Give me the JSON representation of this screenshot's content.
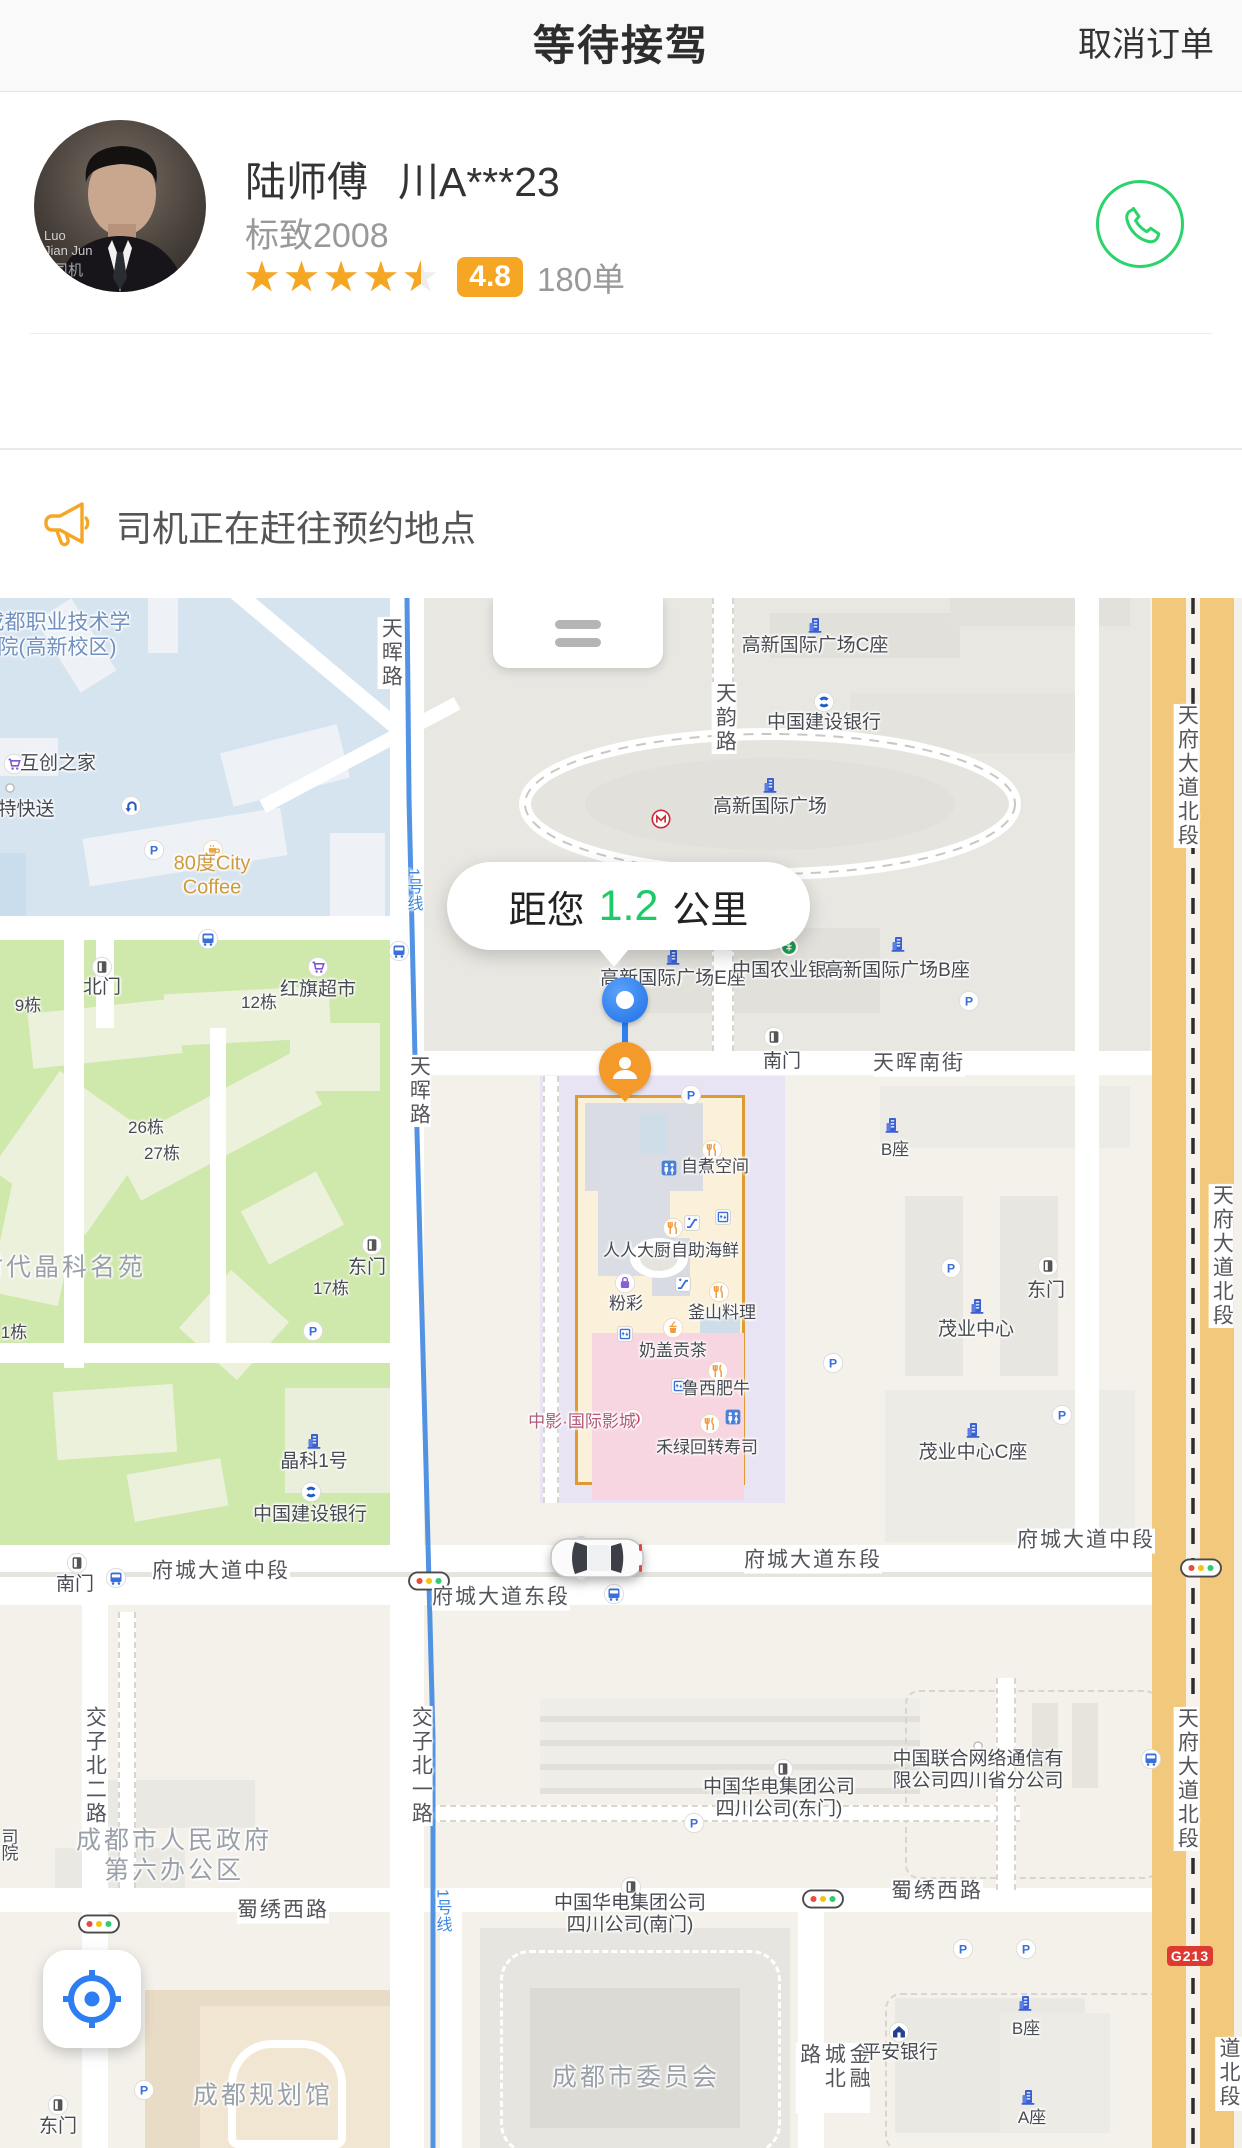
{
  "header": {
    "title": "等待接驾",
    "cancel_button": "取消订单"
  },
  "driver": {
    "name": "陆师傅",
    "plate": "川A***23",
    "car_model": "标致2008",
    "rating_value": 4.5,
    "rating_badge": "4.8",
    "order_count": "180单",
    "avatar_text": [
      "Luo",
      "Jian Jun",
      "安司机"
    ]
  },
  "notice": {
    "text": "司机正在赶往预约地点"
  },
  "colors": {
    "accent_orange": "#F5A623",
    "phone_green": "#2BD36B",
    "distance_green": "#1DCB66",
    "metro_blue": "#3F87E0",
    "avenue_orange": "#F2C87C"
  },
  "map": {
    "distance_bubble": {
      "prefix": "距您",
      "value": "1.2",
      "unit": "公里"
    },
    "g213_badge": "G213",
    "labels": [
      {
        "t": "成都职业技术学\n院(高新校区)",
        "x": 57,
        "y": 38,
        "c": "blue ml"
      },
      {
        "t": "天晖路",
        "x": 390,
        "y": 55,
        "c": "road vert"
      },
      {
        "t": "互创之家",
        "x": 58,
        "y": 166
      },
      {
        "t": "特快送",
        "x": 26,
        "y": 212
      },
      {
        "t": "80度City\nCoffee",
        "x": 212,
        "y": 278,
        "c": "orange ml"
      },
      {
        "t": "高新国际广场C座",
        "x": 815,
        "y": 48
      },
      {
        "t": "中国建设银行",
        "x": 824,
        "y": 125
      },
      {
        "t": "天韵路",
        "x": 724,
        "y": 120,
        "c": "road vert"
      },
      {
        "t": "高新国际广场",
        "x": 770,
        "y": 209
      },
      {
        "t": "天府大道北段",
        "x": 1186,
        "y": 178,
        "c": "road vert"
      },
      {
        "t": "1号线",
        "x": 412,
        "y": 292,
        "c": "metro vert"
      },
      {
        "t": "北门",
        "x": 102,
        "y": 390
      },
      {
        "t": "9栋",
        "x": 28,
        "y": 408,
        "c": "small"
      },
      {
        "t": "12栋",
        "x": 259,
        "y": 405,
        "c": "small"
      },
      {
        "t": "红旗超市",
        "x": 318,
        "y": 392
      },
      {
        "t": "26栋",
        "x": 146,
        "y": 530,
        "c": "small"
      },
      {
        "t": "27栋",
        "x": 162,
        "y": 556,
        "c": "small"
      },
      {
        "t": "时代晶科名苑",
        "x": 62,
        "y": 670,
        "c": "gray"
      },
      {
        "t": "东门",
        "x": 367,
        "y": 670
      },
      {
        "t": "17栋",
        "x": 331,
        "y": 691,
        "c": "small"
      },
      {
        "t": "1栋",
        "x": 14,
        "y": 735,
        "c": "small"
      },
      {
        "t": "晶科1号",
        "x": 314,
        "y": 864
      },
      {
        "t": "中国建设银行",
        "x": 310,
        "y": 917
      },
      {
        "t": "南门",
        "x": 75,
        "y": 987
      },
      {
        "t": "府城大道中段",
        "x": 221,
        "y": 974,
        "c": "road"
      },
      {
        "t": "府城大道东段",
        "x": 501,
        "y": 1000,
        "c": "road"
      },
      {
        "t": "府城大道东段",
        "x": 813,
        "y": 963,
        "c": "road"
      },
      {
        "t": "府城大道中段",
        "x": 1086,
        "y": 943,
        "c": "road"
      },
      {
        "t": "交子北一路",
        "x": 420,
        "y": 1168,
        "c": "road vert"
      },
      {
        "t": "交子北二路",
        "x": 94,
        "y": 1168,
        "c": "road vert"
      },
      {
        "t": "蜀绣西路",
        "x": 283,
        "y": 1313,
        "c": "road"
      },
      {
        "t": "蜀绣西路",
        "x": 937,
        "y": 1294,
        "c": "road"
      },
      {
        "t": "成都市人民政府\n第六办公区",
        "x": 174,
        "y": 1258,
        "c": "gray ml"
      },
      {
        "t": "司",
        "x": 10,
        "y": 1240,
        "c": "small"
      },
      {
        "t": "院",
        "x": 10,
        "y": 1256,
        "c": "small"
      },
      {
        "t": "成都规划馆",
        "x": 263,
        "y": 1498,
        "c": "gray"
      },
      {
        "t": "东门",
        "x": 58,
        "y": 1529
      },
      {
        "t": "中国华电集团公司\n四川公司(东门)",
        "x": 779,
        "y": 1201,
        "c": "ml"
      },
      {
        "t": "中国华电集团公司\n四川公司(南门)",
        "x": 630,
        "y": 1317,
        "c": "ml"
      },
      {
        "t": "成都市委员会",
        "x": 636,
        "y": 1480,
        "c": "gray"
      },
      {
        "t": "金融城北路",
        "x": 833,
        "y": 1480,
        "c": "road vert"
      },
      {
        "t": "平安银行",
        "x": 900,
        "y": 1455
      },
      {
        "t": "中国联合网络通信有\n限公司四川省分公司",
        "x": 978,
        "y": 1173,
        "c": "ml"
      },
      {
        "t": "B座",
        "x": 1026,
        "y": 1431,
        "c": "small"
      },
      {
        "t": "A座",
        "x": 1032,
        "y": 1520,
        "c": "small"
      },
      {
        "t": "天府大道北段",
        "x": 1221,
        "y": 658,
        "c": "road vert"
      },
      {
        "t": "天府大道北段",
        "x": 1186,
        "y": 1181,
        "c": "road vert"
      },
      {
        "t": "天府大道北段",
        "x": 1240,
        "y": 1476,
        "c": "road vert"
      },
      {
        "t": "高新国际广场E座",
        "x": 673,
        "y": 381
      },
      {
        "t": "中国农业银行",
        "x": 789,
        "y": 373
      },
      {
        "t": "高新国际广场B座",
        "x": 897,
        "y": 373
      },
      {
        "t": "南门",
        "x": 782,
        "y": 464
      },
      {
        "t": "天晖南街",
        "x": 919,
        "y": 466,
        "c": "road"
      },
      {
        "t": "B座",
        "x": 895,
        "y": 552,
        "c": "small"
      },
      {
        "t": "天晖路",
        "x": 418,
        "y": 493,
        "c": "road vert"
      },
      {
        "t": "东门",
        "x": 1046,
        "y": 693
      },
      {
        "t": "茂业中心",
        "x": 976,
        "y": 732
      },
      {
        "t": "茂业中心C座",
        "x": 973,
        "y": 855
      },
      {
        "t": "自煮空间",
        "x": 715,
        "y": 569,
        "c": "small"
      },
      {
        "t": "人人大厨自助海鲜",
        "x": 671,
        "y": 653,
        "c": "small"
      },
      {
        "t": "粉彩",
        "x": 626,
        "y": 706,
        "c": "small"
      },
      {
        "t": "釜山料理",
        "x": 722,
        "y": 715,
        "c": "small"
      },
      {
        "t": "奶盖贡茶",
        "x": 673,
        "y": 753,
        "c": "small"
      },
      {
        "t": "鲁西肥牛",
        "x": 716,
        "y": 791,
        "c": "small"
      },
      {
        "t": "中影·国际影城",
        "x": 582,
        "y": 824,
        "c": "pinkl"
      },
      {
        "t": "禾绿回转寿司",
        "x": 707,
        "y": 850,
        "c": "small"
      },
      {
        "t": "1号线",
        "x": 441,
        "y": 1313,
        "c": "metro vert"
      }
    ],
    "icons": [
      {
        "k": "cart",
        "x": 14,
        "y": 166
      },
      {
        "k": "dot",
        "x": 10,
        "y": 190
      },
      {
        "k": "coffee",
        "x": 213,
        "y": 252
      },
      {
        "k": "uturn",
        "x": 131,
        "y": 208
      },
      {
        "k": "parking",
        "x": 154,
        "y": 252
      },
      {
        "k": "bldg",
        "x": 815,
        "y": 27
      },
      {
        "k": "ccb",
        "x": 824,
        "y": 104
      },
      {
        "k": "bldg",
        "x": 770,
        "y": 187
      },
      {
        "k": "metro",
        "x": 661,
        "y": 221
      },
      {
        "k": "bus",
        "x": 208,
        "y": 341
      },
      {
        "k": "bus",
        "x": 399,
        "y": 353
      },
      {
        "k": "door",
        "x": 102,
        "y": 369
      },
      {
        "k": "cart",
        "x": 318,
        "y": 369
      },
      {
        "k": "door",
        "x": 372,
        "y": 647
      },
      {
        "k": "parking",
        "x": 313,
        "y": 733
      },
      {
        "k": "bldg",
        "x": 314,
        "y": 843
      },
      {
        "k": "ccb",
        "x": 311,
        "y": 894
      },
      {
        "k": "door",
        "x": 77,
        "y": 965
      },
      {
        "k": "bus",
        "x": 116,
        "y": 980
      },
      {
        "k": "tlight",
        "x": 429,
        "y": 983
      },
      {
        "k": "tlight",
        "x": 1201,
        "y": 970
      },
      {
        "k": "tlight",
        "x": 99,
        "y": 1326
      },
      {
        "k": "tlight",
        "x": 823,
        "y": 1301
      },
      {
        "k": "bus",
        "x": 614,
        "y": 996
      },
      {
        "k": "door",
        "x": 58,
        "y": 1507
      },
      {
        "k": "parking",
        "x": 144,
        "y": 1492
      },
      {
        "k": "door",
        "x": 783,
        "y": 1171
      },
      {
        "k": "parking",
        "x": 694,
        "y": 1225
      },
      {
        "k": "door",
        "x": 631,
        "y": 1289
      },
      {
        "k": "pingan",
        "x": 899,
        "y": 1434
      },
      {
        "k": "dot",
        "x": 978,
        "y": 1148
      },
      {
        "k": "bus",
        "x": 1151,
        "y": 1161
      },
      {
        "k": "parking",
        "x": 963,
        "y": 1351
      },
      {
        "k": "parking",
        "x": 1026,
        "y": 1351
      },
      {
        "k": "bldg",
        "x": 1025,
        "y": 1405
      },
      {
        "k": "bldg",
        "x": 1028,
        "y": 1499
      },
      {
        "k": "bldg",
        "x": 673,
        "y": 359
      },
      {
        "k": "abc",
        "x": 789,
        "y": 349
      },
      {
        "k": "bldg",
        "x": 898,
        "y": 346
      },
      {
        "k": "parking",
        "x": 969,
        "y": 403
      },
      {
        "k": "door",
        "x": 774,
        "y": 439
      },
      {
        "k": "bldg",
        "x": 892,
        "y": 527
      },
      {
        "k": "parking",
        "x": 951,
        "y": 670
      },
      {
        "k": "door",
        "x": 1048,
        "y": 668
      },
      {
        "k": "bldg",
        "x": 977,
        "y": 708
      },
      {
        "k": "bldg",
        "x": 973,
        "y": 832
      },
      {
        "k": "parking",
        "x": 1062,
        "y": 817
      },
      {
        "k": "parking",
        "x": 833,
        "y": 765
      },
      {
        "k": "parking",
        "x": 691,
        "y": 497
      },
      {
        "k": "fork",
        "x": 712,
        "y": 552
      },
      {
        "k": "wc",
        "x": 669,
        "y": 570
      },
      {
        "k": "fork",
        "x": 673,
        "y": 630
      },
      {
        "k": "esc",
        "x": 692,
        "y": 625
      },
      {
        "k": "elv",
        "x": 723,
        "y": 619
      },
      {
        "k": "bag",
        "x": 625,
        "y": 685
      },
      {
        "k": "esc",
        "x": 683,
        "y": 686
      },
      {
        "k": "fork",
        "x": 719,
        "y": 694
      },
      {
        "k": "drink",
        "x": 673,
        "y": 730
      },
      {
        "k": "elv",
        "x": 625,
        "y": 736
      },
      {
        "k": "fork",
        "x": 718,
        "y": 773
      },
      {
        "k": "elv",
        "x": 679,
        "y": 788
      },
      {
        "k": "cine",
        "x": 633,
        "y": 821
      },
      {
        "k": "fork",
        "x": 710,
        "y": 826
      },
      {
        "k": "wc",
        "x": 733,
        "y": 819
      }
    ]
  }
}
